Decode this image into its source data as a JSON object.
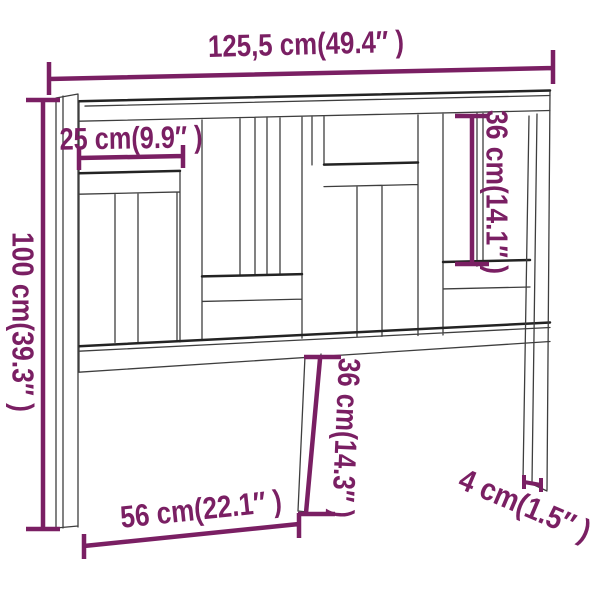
{
  "product_diagram": {
    "type": "furniture-dimension-drawing",
    "subject": "bed-headboard",
    "colors": {
      "dimension_accent": "#7a1f63",
      "drawing_line": "#3e3e3e",
      "drawing_line_dark": "#232323",
      "background": "#ffffff"
    },
    "dimensions": {
      "overall_width": "125,5 cm(49.4″ )",
      "overall_height": "100 cm(39.3″ )",
      "top_left_board_width": "25 cm(9.9″ )",
      "upper_right_slat_height": "36 cm(14.1″ )",
      "lower_middle_leg_height": "36 cm(14.3″ )",
      "leg_spacing_width": "56 cm(22.1″ )",
      "board_thickness": "4 cm(1.5″ )"
    }
  }
}
